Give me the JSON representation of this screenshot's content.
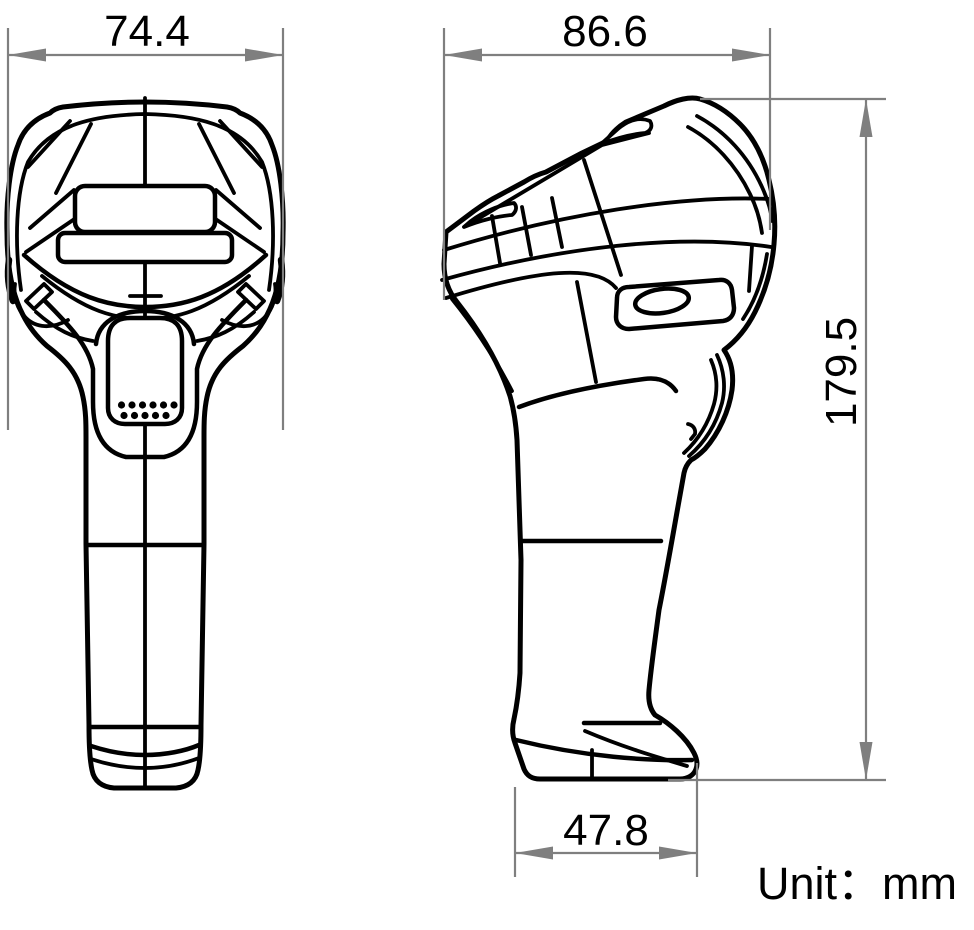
{
  "dimensions": {
    "front_width": {
      "value": "74.4"
    },
    "head_depth": {
      "value": "86.6"
    },
    "overall_height": {
      "value": "179.5"
    },
    "base_depth": {
      "value": "47.8"
    }
  },
  "unit_label": "Unit：mm",
  "colors": {
    "line": "#000000",
    "dimension": "#7f7f7f",
    "label": "#000000",
    "background": "#ffffff"
  }
}
